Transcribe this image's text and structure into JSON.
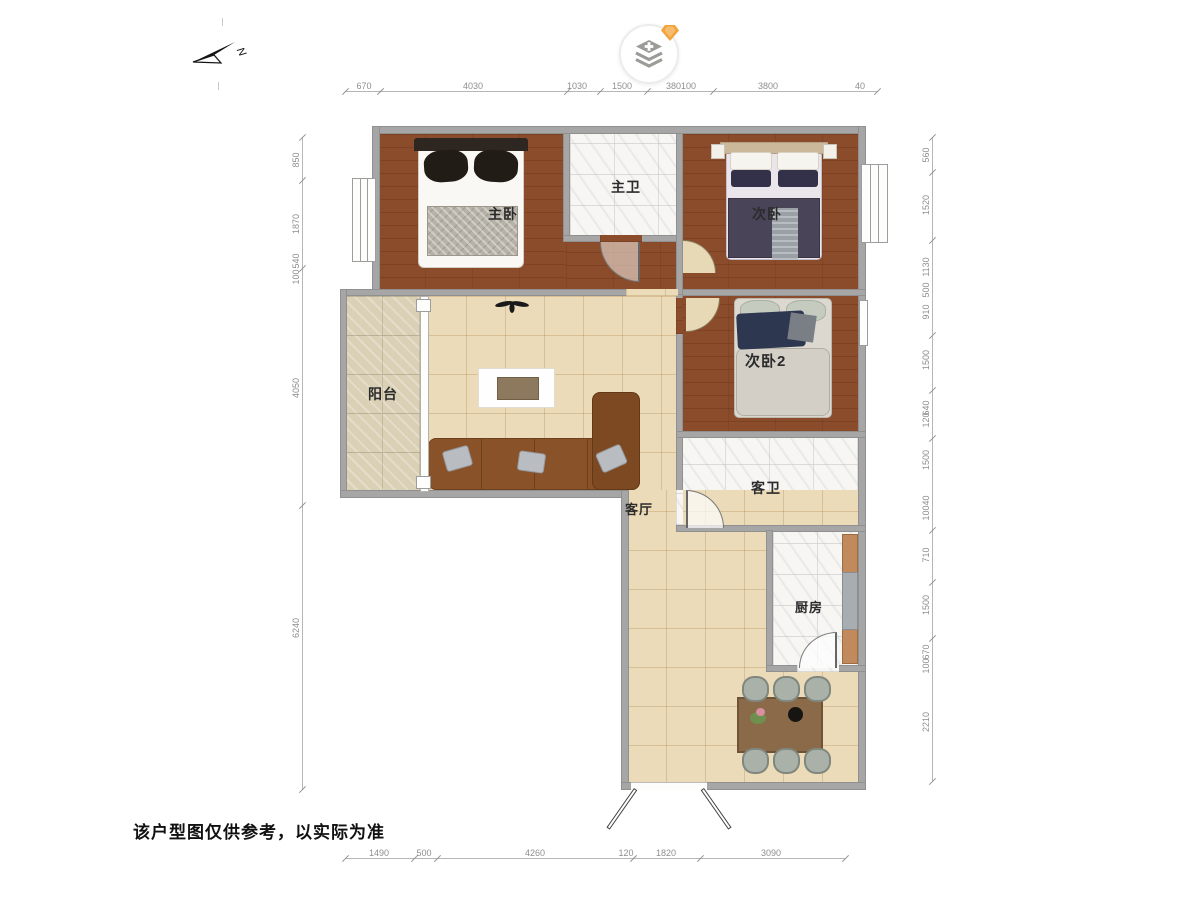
{
  "compass": {
    "label": "N"
  },
  "toolbar": {
    "layers_button": "layers",
    "badge": "diamond"
  },
  "rooms": {
    "master_bedroom": "主卧",
    "master_bath": "主卫",
    "bedroom2": "次卧",
    "bedroom3": "次卧2",
    "guest_bath": "客卫",
    "balcony": "阳台",
    "living": "客厅",
    "kitchen": "厨房"
  },
  "dimensions": {
    "top": [
      "670",
      "4030",
      "1030",
      "1500",
      "380100",
      "3800",
      "40"
    ],
    "bottom": [
      "1490",
      "500",
      "4260",
      "120",
      "1820",
      "3090"
    ],
    "left": [
      "850",
      "1870",
      "540",
      "100",
      "4050",
      "6240"
    ],
    "right": [
      "560",
      "1520",
      "1130",
      "500",
      "910",
      "1500",
      "640",
      "120",
      "1500",
      "10040",
      "710",
      "1500",
      "670",
      "100",
      "2210"
    ]
  },
  "footer": {
    "disclaimer": "该户型图仅供参考，以实际为准"
  },
  "colors": {
    "wall": "#a6a6a6",
    "wood_floor": "#8b4c2b",
    "tile_floor": "#ecdbb8",
    "stone_floor": "#d9d0b5",
    "marble_floor": "#f7f6f3",
    "sofa": "#8a5229",
    "badge_orange": "#f3a33b",
    "dim_text": "#8e8e8e"
  }
}
